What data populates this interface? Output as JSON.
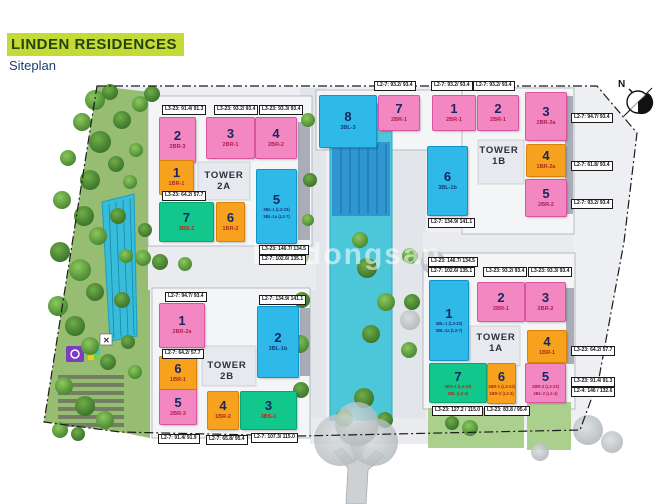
{
  "header": {
    "title": "LINDEN RESIDENCES",
    "subtitle": "Siteplan"
  },
  "compass": {
    "north_label": "N"
  },
  "watermark": {
    "text": "batdongsan"
  },
  "palette": {
    "pink": {
      "bg": "#F287C2",
      "border": "#D9559F",
      "sub": "#B11D50"
    },
    "orange": {
      "bg": "#F6A21E",
      "border": "#D9820A",
      "sub": "#B02A1A"
    },
    "cyan": {
      "bg": "#2EB9E9",
      "border": "#0F93C9",
      "sub": "#16377F"
    },
    "green": {
      "bg": "#12C78C",
      "border": "#0AA371",
      "sub": "#B02A1A"
    }
  },
  "tower_labels": [
    {
      "line1": "TOWER",
      "line2": "2A",
      "x": 224,
      "y": 170
    },
    {
      "line1": "TOWER",
      "line2": "1B",
      "x": 499,
      "y": 145
    },
    {
      "line1": "TOWER",
      "line2": "2B",
      "x": 227,
      "y": 360
    },
    {
      "line1": "TOWER",
      "line2": "1A",
      "x": 496,
      "y": 332
    }
  ],
  "units": [
    {
      "tower": "2A",
      "num": "2",
      "types": [
        "2BR-3"
      ],
      "color": "pink",
      "rect": [
        160,
        118,
        35,
        44
      ]
    },
    {
      "tower": "2A",
      "num": "3",
      "types": [
        "2BR-1"
      ],
      "color": "pink",
      "rect": [
        207,
        118,
        47,
        40
      ]
    },
    {
      "tower": "2A",
      "num": "4",
      "types": [
        "2BR-2"
      ],
      "color": "pink",
      "rect": [
        256,
        118,
        40,
        40
      ]
    },
    {
      "tower": "2A",
      "num": "1",
      "types": [
        "1BR-1"
      ],
      "color": "orange",
      "rect": [
        160,
        161,
        33,
        33
      ]
    },
    {
      "tower": "2A",
      "num": "7",
      "types": [
        "3BS-1"
      ],
      "color": "green",
      "rect": [
        160,
        203,
        53,
        38
      ]
    },
    {
      "tower": "2A",
      "num": "6",
      "types": [
        "1BR-2"
      ],
      "color": "orange",
      "rect": [
        217,
        203,
        27,
        38
      ]
    },
    {
      "tower": "2A",
      "num": "5",
      "types": [
        "3BL-1 (L3-23)",
        "3BL-1a (L2-7)"
      ],
      "color": "cyan",
      "rect": [
        257,
        170,
        39,
        73
      ]
    },
    {
      "tower": "1B",
      "num": "8",
      "types": [
        "3BL-3"
      ],
      "color": "cyan",
      "rect": [
        320,
        96,
        56,
        51
      ]
    },
    {
      "tower": "1B",
      "num": "7",
      "types": [
        "2BR-1"
      ],
      "color": "pink",
      "rect": [
        379,
        96,
        40,
        34
      ]
    },
    {
      "tower": "1B",
      "num": "1",
      "types": [
        "2BR-1"
      ],
      "color": "pink",
      "rect": [
        433,
        96,
        42,
        34
      ]
    },
    {
      "tower": "1B",
      "num": "2",
      "types": [
        "2BR-1"
      ],
      "color": "pink",
      "rect": [
        478,
        96,
        40,
        34
      ]
    },
    {
      "tower": "1B",
      "num": "3",
      "types": [
        "2BR-2a"
      ],
      "color": "pink",
      "rect": [
        526,
        93,
        40,
        47
      ]
    },
    {
      "tower": "1B",
      "num": "4",
      "types": [
        "1BR-2a"
      ],
      "color": "orange",
      "rect": [
        527,
        145,
        38,
        31
      ]
    },
    {
      "tower": "1B",
      "num": "5",
      "types": [
        "2BR-2"
      ],
      "color": "pink",
      "rect": [
        526,
        180,
        40,
        36
      ]
    },
    {
      "tower": "1B",
      "num": "6",
      "types": [
        "3BL-1b"
      ],
      "color": "cyan",
      "rect": [
        428,
        147,
        39,
        68
      ]
    },
    {
      "tower": "2B",
      "num": "1",
      "types": [
        "2BR-2a"
      ],
      "color": "pink",
      "rect": [
        160,
        304,
        44,
        43
      ]
    },
    {
      "tower": "2B",
      "num": "6",
      "types": [
        "1BR-1"
      ],
      "color": "orange",
      "rect": [
        160,
        357,
        36,
        33
      ]
    },
    {
      "tower": "2B",
      "num": "5",
      "types": [
        "2BR-3"
      ],
      "color": "pink",
      "rect": [
        160,
        390,
        36,
        34
      ]
    },
    {
      "tower": "2B",
      "num": "4",
      "types": [
        "1BR-2"
      ],
      "color": "orange",
      "rect": [
        208,
        392,
        30,
        37
      ]
    },
    {
      "tower": "2B",
      "num": "3",
      "types": [
        "3BS-1"
      ],
      "color": "green",
      "rect": [
        241,
        392,
        55,
        37
      ]
    },
    {
      "tower": "2B",
      "num": "2",
      "types": [
        "3BL-1b"
      ],
      "color": "cyan",
      "rect": [
        258,
        307,
        40,
        70
      ]
    },
    {
      "tower": "1A",
      "num": "1",
      "types": [
        "3BL-1 (L3-23)",
        "3BL-1a (L2-7)"
      ],
      "color": "cyan",
      "rect": [
        430,
        281,
        38,
        79
      ]
    },
    {
      "tower": "1A",
      "num": "2",
      "types": [
        "2BR-1"
      ],
      "color": "pink",
      "rect": [
        478,
        283,
        46,
        38
      ]
    },
    {
      "tower": "1A",
      "num": "3",
      "types": [
        "2BR-2"
      ],
      "color": "pink",
      "rect": [
        526,
        283,
        39,
        38
      ]
    },
    {
      "tower": "1A",
      "num": "4",
      "types": [
        "1BR-1"
      ],
      "color": "orange",
      "rect": [
        528,
        331,
        38,
        31
      ]
    },
    {
      "tower": "1A",
      "num": "7",
      "types": [
        "3BS-1 (L3-23)",
        "3BL (L2-4)"
      ],
      "color": "green",
      "rect": [
        430,
        364,
        56,
        38
      ]
    },
    {
      "tower": "1A",
      "num": "6",
      "types": [
        "1BR-1 (L3-23)",
        "1BR-2 (L2-4)"
      ],
      "color": "orange",
      "rect": [
        488,
        364,
        27,
        39
      ]
    },
    {
      "tower": "1A",
      "num": "5",
      "types": [
        "2BR-3 (L3-23)",
        "3BL-2 (L2-4)"
      ],
      "color": "pink",
      "rect": [
        526,
        364,
        39,
        38
      ]
    }
  ],
  "area_labels": [
    {
      "text": "L3-23: 91.4/ 91.3",
      "x": 162,
      "y": 105
    },
    {
      "text": "L3-23: 93.2/ 93.4",
      "x": 214,
      "y": 105
    },
    {
      "text": "L3-23: 93.3/ 93.4",
      "x": 259,
      "y": 105
    },
    {
      "text": "L3-23: 64.2/ 57.7",
      "x": 162,
      "y": 191
    },
    {
      "text": "L3-23: 146.7/ 134.5",
      "x": 259,
      "y": 245
    },
    {
      "text": "L2-7: 102.6/ 135.1",
      "x": 259,
      "y": 255
    },
    {
      "text": "L2-7: 93.2/ 93.4",
      "x": 374,
      "y": 81
    },
    {
      "text": "L2-7: 93.2/ 93.4",
      "x": 431,
      "y": 81
    },
    {
      "text": "L2-7: 93.2/ 93.4",
      "x": 473,
      "y": 81
    },
    {
      "text": "L2-7: 94.7/ 93.4",
      "x": 571,
      "y": 113
    },
    {
      "text": "L2-7: 61.8/ 93.4",
      "x": 571,
      "y": 161
    },
    {
      "text": "L2-7: 93.2/ 93.4",
      "x": 571,
      "y": 199
    },
    {
      "text": "L2-7: 134.9/ 141.1",
      "x": 428,
      "y": 218
    },
    {
      "text": "L2-7: 94.7/ 93.4",
      "x": 165,
      "y": 292
    },
    {
      "text": "L2-7: 134.9/ 141.1",
      "x": 259,
      "y": 295
    },
    {
      "text": "L2-7: 64.2/ 57.7",
      "x": 162,
      "y": 349
    },
    {
      "text": "L2-7: 91.4/ 91.9",
      "x": 158,
      "y": 434
    },
    {
      "text": "L2-7: 65.8/ 95.4",
      "x": 206,
      "y": 435
    },
    {
      "text": "L2-7: 107.3/ 115.0",
      "x": 251,
      "y": 433
    },
    {
      "text": "L3-23: 146.7/ 134.5",
      "x": 428,
      "y": 257
    },
    {
      "text": "L2-7: 102.6/ 135.1",
      "x": 428,
      "y": 267
    },
    {
      "text": "L3-23: 93.2/ 93.4",
      "x": 483,
      "y": 267
    },
    {
      "text": "L3-23: 93.3/ 93.4",
      "x": 528,
      "y": 267
    },
    {
      "text": "L3-23: 64.2/ 57.7",
      "x": 571,
      "y": 346
    },
    {
      "text": "L3-23: 91.4/ 91.3",
      "x": 571,
      "y": 377
    },
    {
      "text": "L2-4: 146 / 132.6",
      "x": 571,
      "y": 387
    },
    {
      "text": "L3-23: 127.2 / 115.0",
      "x": 432,
      "y": 406
    },
    {
      "text": "L3-23: 83.8 / 95.4",
      "x": 484,
      "y": 406
    }
  ]
}
